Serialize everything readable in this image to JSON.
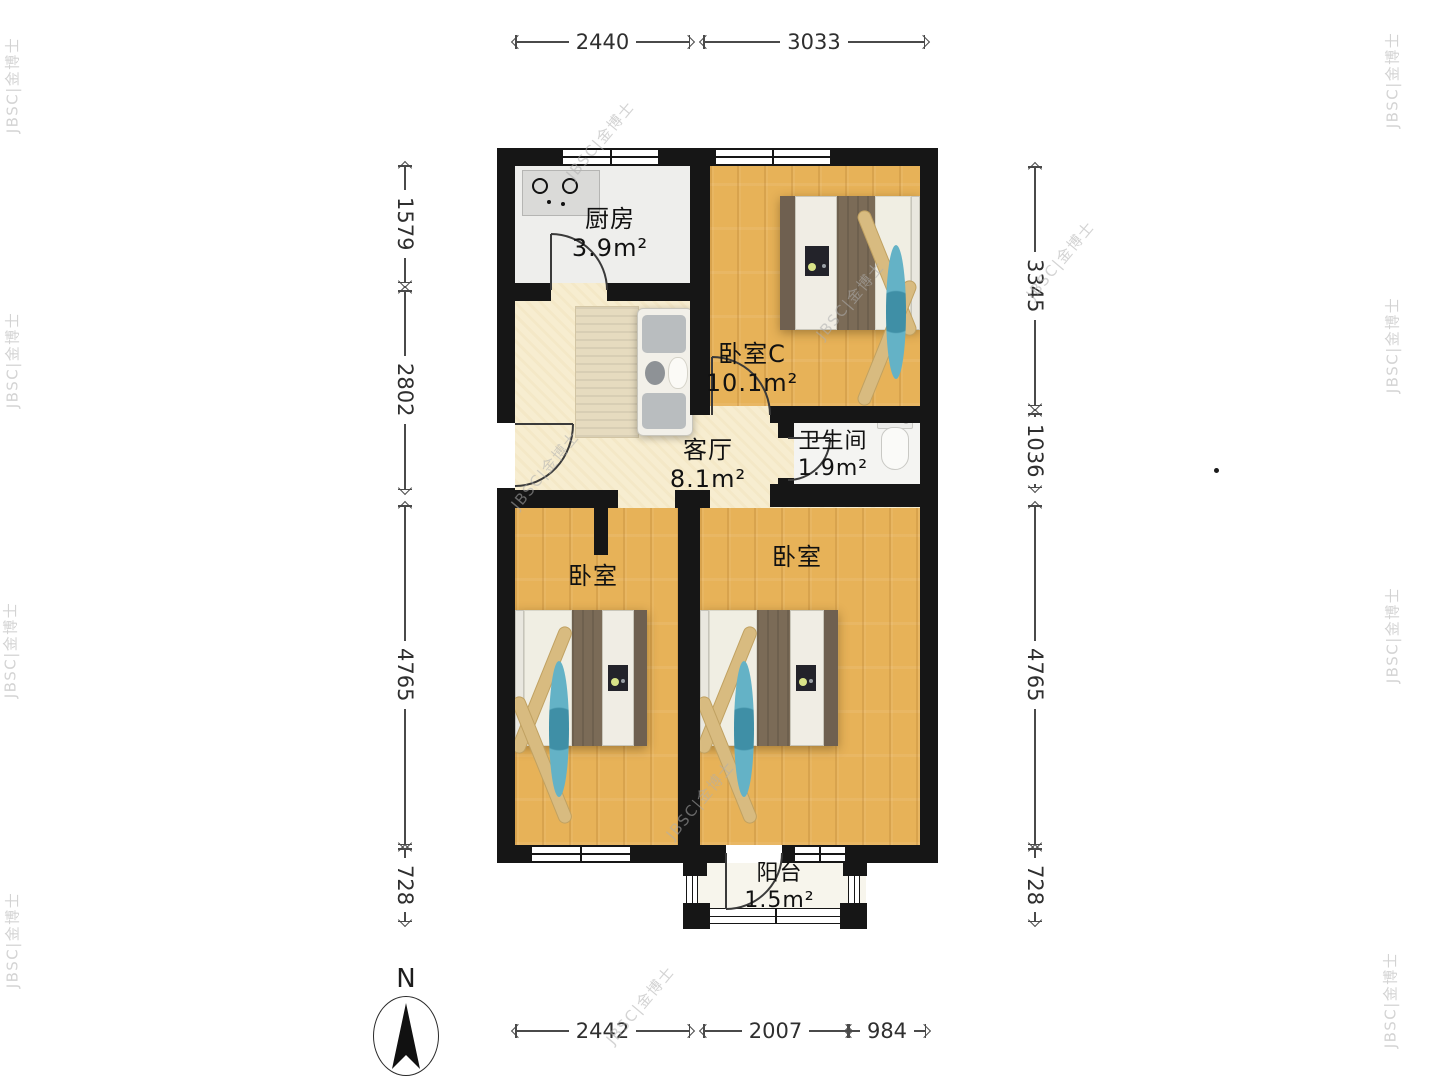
{
  "watermark": {
    "text": "JBSC|金博士"
  },
  "compass": {
    "label": "N"
  },
  "rooms": {
    "kitchen": {
      "name": "厨房",
      "area": "3.9m²"
    },
    "bedroom_c": {
      "name": "卧室C",
      "area": "10.1m²"
    },
    "bathroom": {
      "name": "卫生间",
      "area": "1.9m²"
    },
    "living": {
      "name": "客厅",
      "area": "8.1m²"
    },
    "bedroom_left": {
      "name": "卧室"
    },
    "bedroom_right": {
      "name": "卧室"
    },
    "balcony": {
      "name": "阳台",
      "area": "1.5m²"
    }
  },
  "dimensions": {
    "top": [
      "2440",
      "3033"
    ],
    "left": [
      "1579",
      "2802",
      "4765",
      "728"
    ],
    "right": [
      "3345",
      "1036",
      "4765",
      "728"
    ],
    "bottom": [
      "2442",
      "2007",
      "984"
    ]
  },
  "colors": {
    "wall": "#161616",
    "wood_floor": "#e7b258",
    "living_floor": "#f7edd0",
    "kitchen_floor": "#eeeeec",
    "furniture_brown": "#7b6b57",
    "accent_blue": "#64b2c6",
    "pillow_tan": "#d8bb80"
  }
}
